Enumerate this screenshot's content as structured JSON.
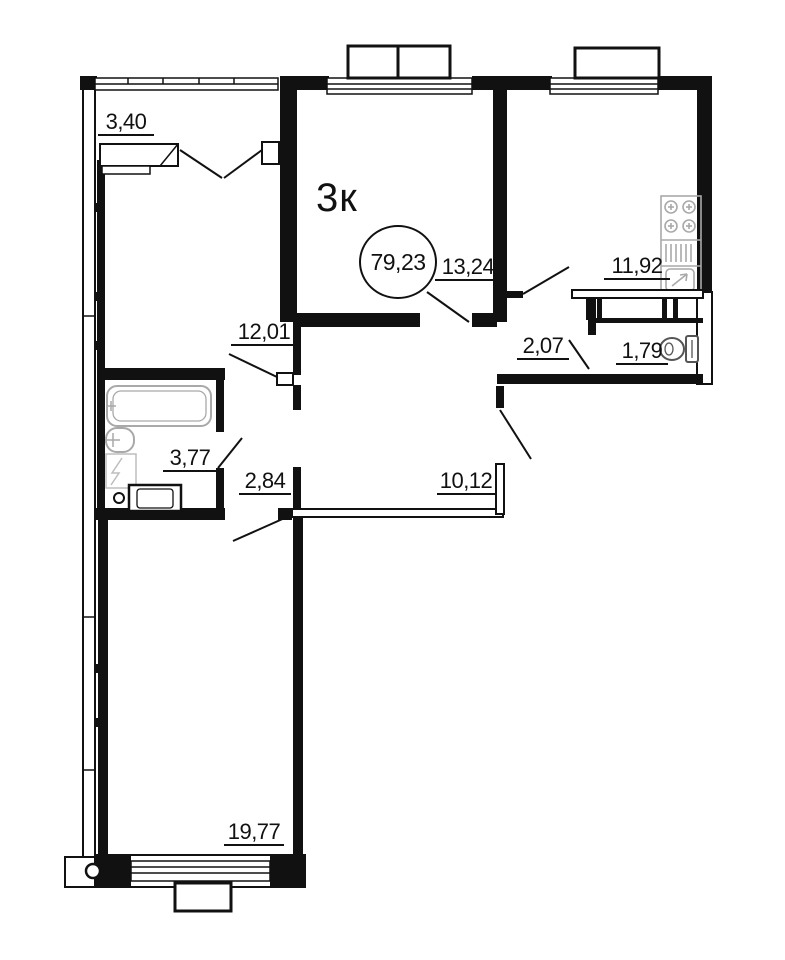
{
  "plan": {
    "type_label": "3к",
    "total_area": "79,23",
    "rooms": [
      {
        "name": "closet",
        "area": "3,40"
      },
      {
        "name": "room-12",
        "area": "12,01"
      },
      {
        "name": "room-13",
        "area": "13,24"
      },
      {
        "name": "kitchen",
        "area": "11,92"
      },
      {
        "name": "hall",
        "area": "2,07"
      },
      {
        "name": "wc",
        "area": "1,79"
      },
      {
        "name": "bathroom",
        "area": "3,77"
      },
      {
        "name": "hallway",
        "area": "2,84"
      },
      {
        "name": "corridor",
        "area": "10,12"
      },
      {
        "name": "living-room",
        "area": "19,77"
      }
    ],
    "colors": {
      "wall": "#111111",
      "fixture": "#a9a9a9",
      "background": "#ffffff"
    }
  }
}
